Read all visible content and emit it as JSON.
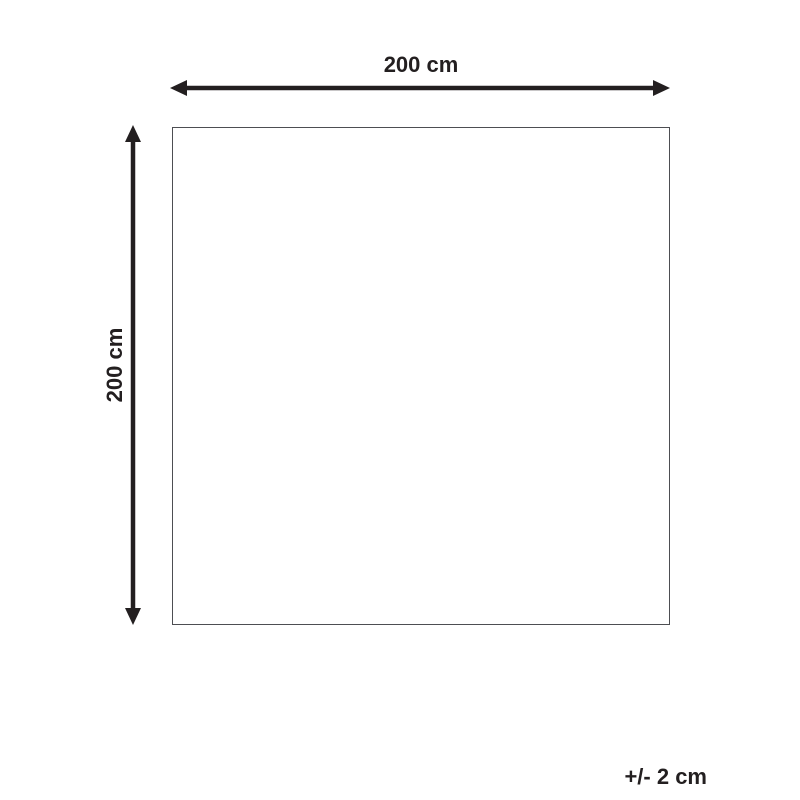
{
  "diagram": {
    "type": "product-dimension-diagram",
    "width_label": "200 cm",
    "height_label": "200 cm",
    "tolerance_label": "+/- 2 cm",
    "shape": "square",
    "colors": {
      "arrow_and_text": "#231f20",
      "outline_border": "#4d4e52",
      "background": "#ffffff"
    }
  }
}
